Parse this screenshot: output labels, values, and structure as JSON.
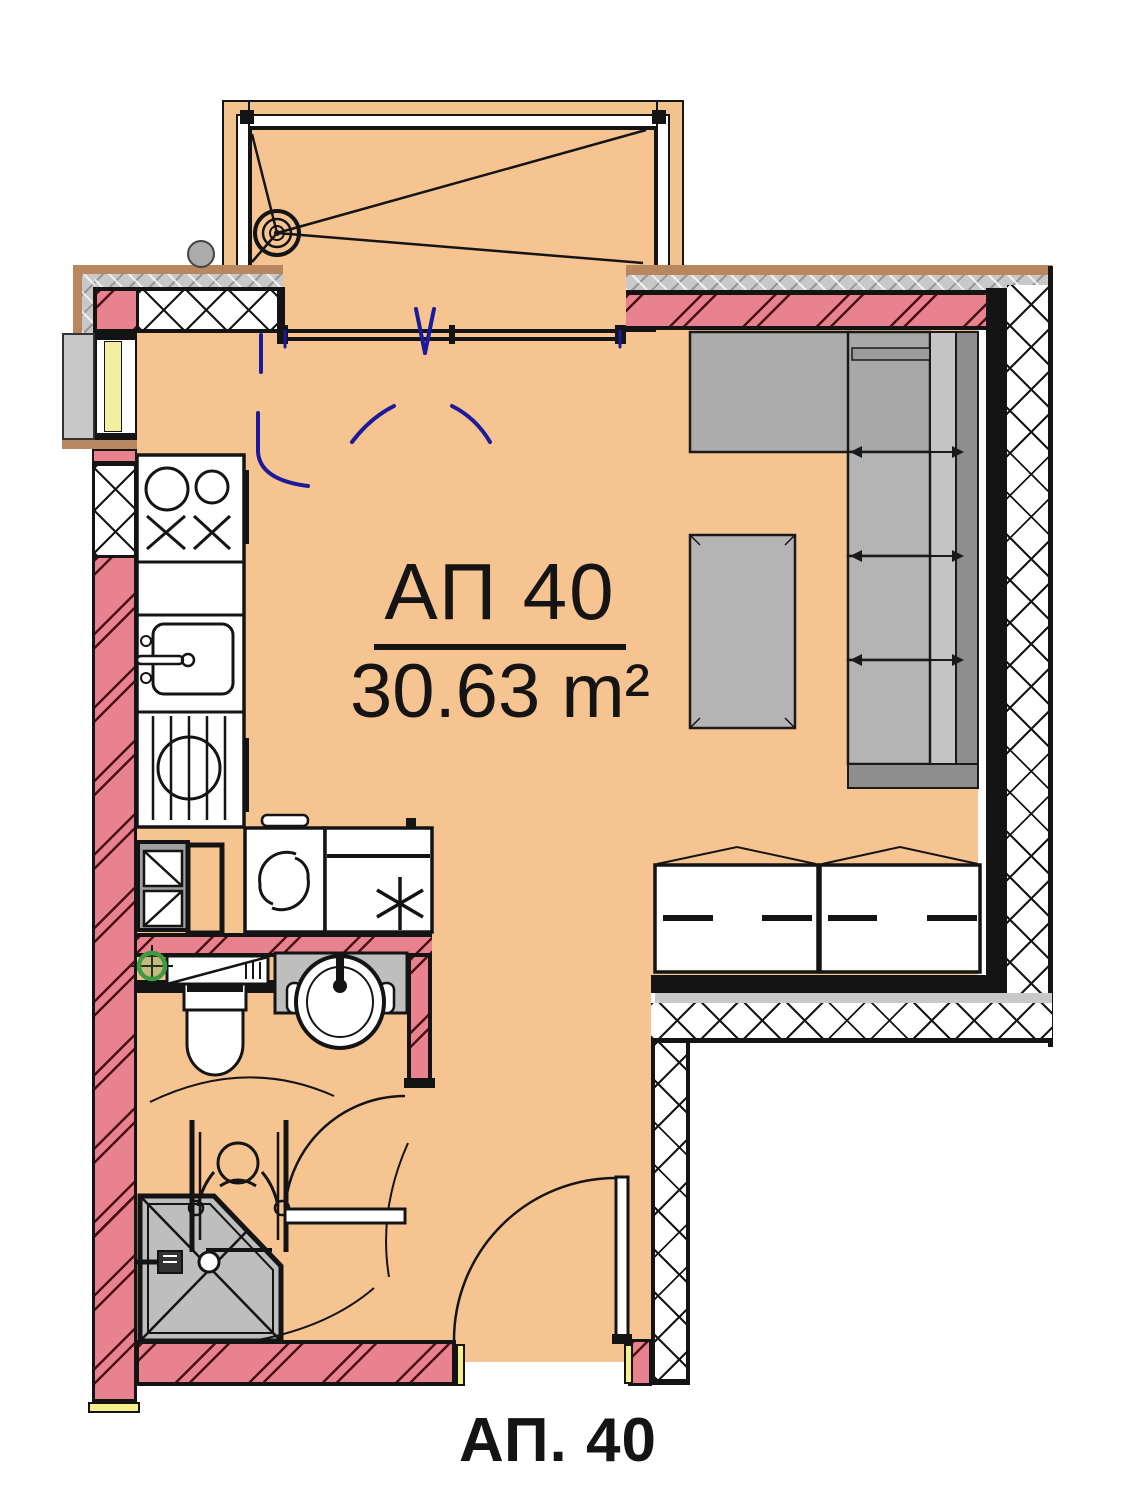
{
  "plan": {
    "unit_label": "АП 40",
    "area_label": "30.63 m²",
    "bottom_label": "АП. 40"
  },
  "colors": {
    "floor_orange": "#F6C491",
    "wall_pink": "#E8828E",
    "balcony_rail_orange": "#F2C38D",
    "furniture_gray": "#B4B4B4",
    "sill_gray": "#C8C8C8",
    "brown_trim": "#B9875F",
    "door_swing_blue": "#1A1A9B",
    "fixture_green": "#3F9B41",
    "line_black": "#141414",
    "jamb_yellow": "#F5F08C",
    "window_yellow": "#F2EFA0"
  },
  "icons": {
    "balcony_drain": "drain-icon",
    "stove": "stove-icon",
    "kitchen_sink": "kitchen-sink-icon",
    "dish_drainer": "dish-drainer-icon",
    "washing_machine": "washing-machine-icon",
    "fridge": "fridge-icon",
    "toilet": "toilet-icon",
    "bathroom_sink": "bathroom-sink-icon",
    "shower": "shower-icon",
    "wheelchair": "wheelchair-icon",
    "sofa": "sofa-icon",
    "coffee_table": "coffee-table-icon",
    "cabinets": "cabinet-icon",
    "vent": "vent-icon",
    "entry_door": "entry-door-icon",
    "bathroom_door": "bathroom-door-icon",
    "balcony_door": "balcony-sliding-door-icon"
  }
}
